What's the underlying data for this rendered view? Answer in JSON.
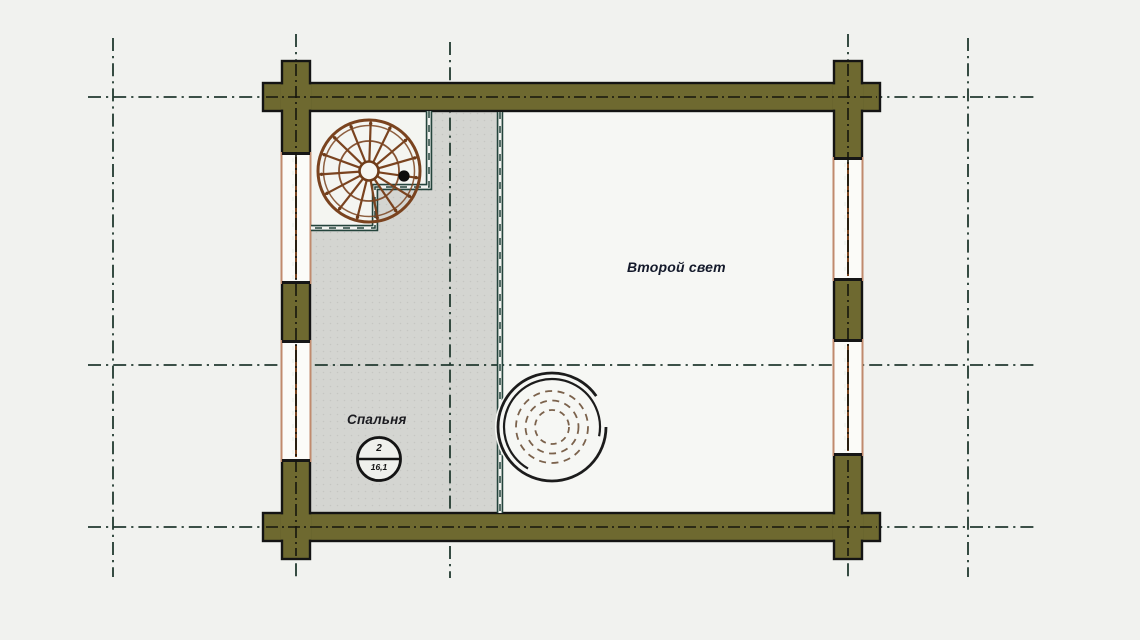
{
  "page": {
    "type": "architectural-floor-plan",
    "language": "ru"
  },
  "labels": {
    "open_space": "Второй свет",
    "bedroom": "Спальня"
  },
  "room_stamp": {
    "number": "2",
    "area": "16,1"
  },
  "colors": {
    "background": "#f1f2ef",
    "interior_fill": "#f6f7f4",
    "floor_fill": "#d4d5d1",
    "wall_fill": "#6e6930",
    "wall_outline": "#141414",
    "axis_line": "#223a30",
    "stair_wood": "#7a431f",
    "window_frame": "#c08a6d",
    "window_mullion": "#76431f",
    "railing": "#24443c",
    "chimney_outline": "#1c1c1c",
    "chimney_dashed": "#7b624c",
    "label_text": "#141a2b"
  }
}
